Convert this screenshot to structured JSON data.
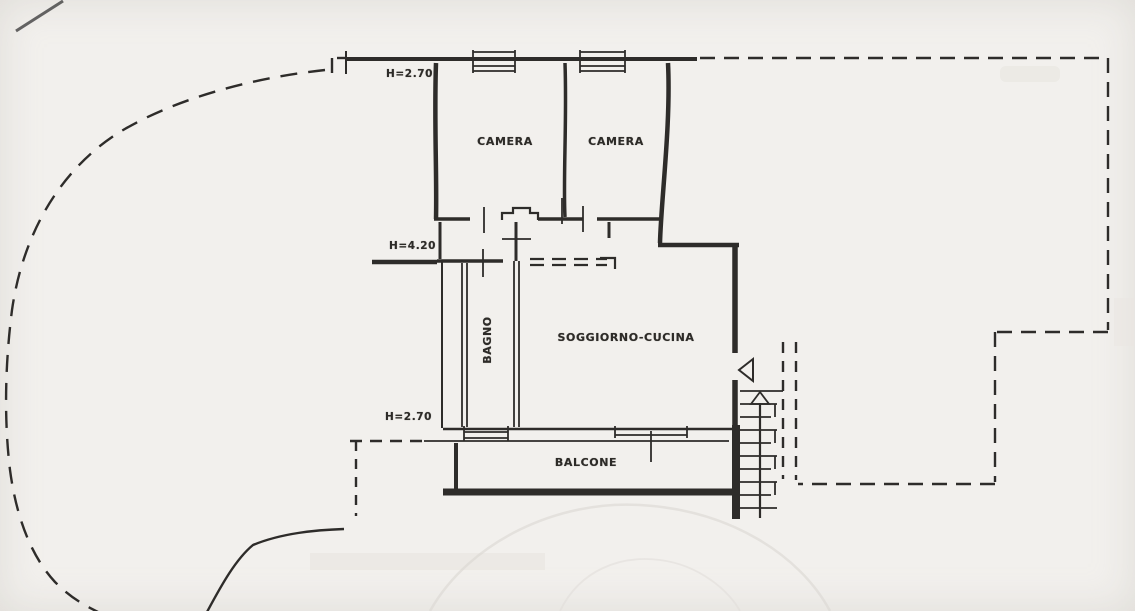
{
  "plan": {
    "heights": {
      "top": "H=2.70",
      "middle": "H=4.20",
      "bottom": "H=2.70"
    },
    "rooms": {
      "camera_left": "CAMERA",
      "camera_right": "CAMERA",
      "bagno": "BAGNO",
      "soggiorno_cucina": "SOGGIORNO-CUCINA",
      "balcone": "BALCONE"
    },
    "colors": {
      "ink": "#2e2c2a",
      "paper": "#f2f0ed"
    }
  }
}
